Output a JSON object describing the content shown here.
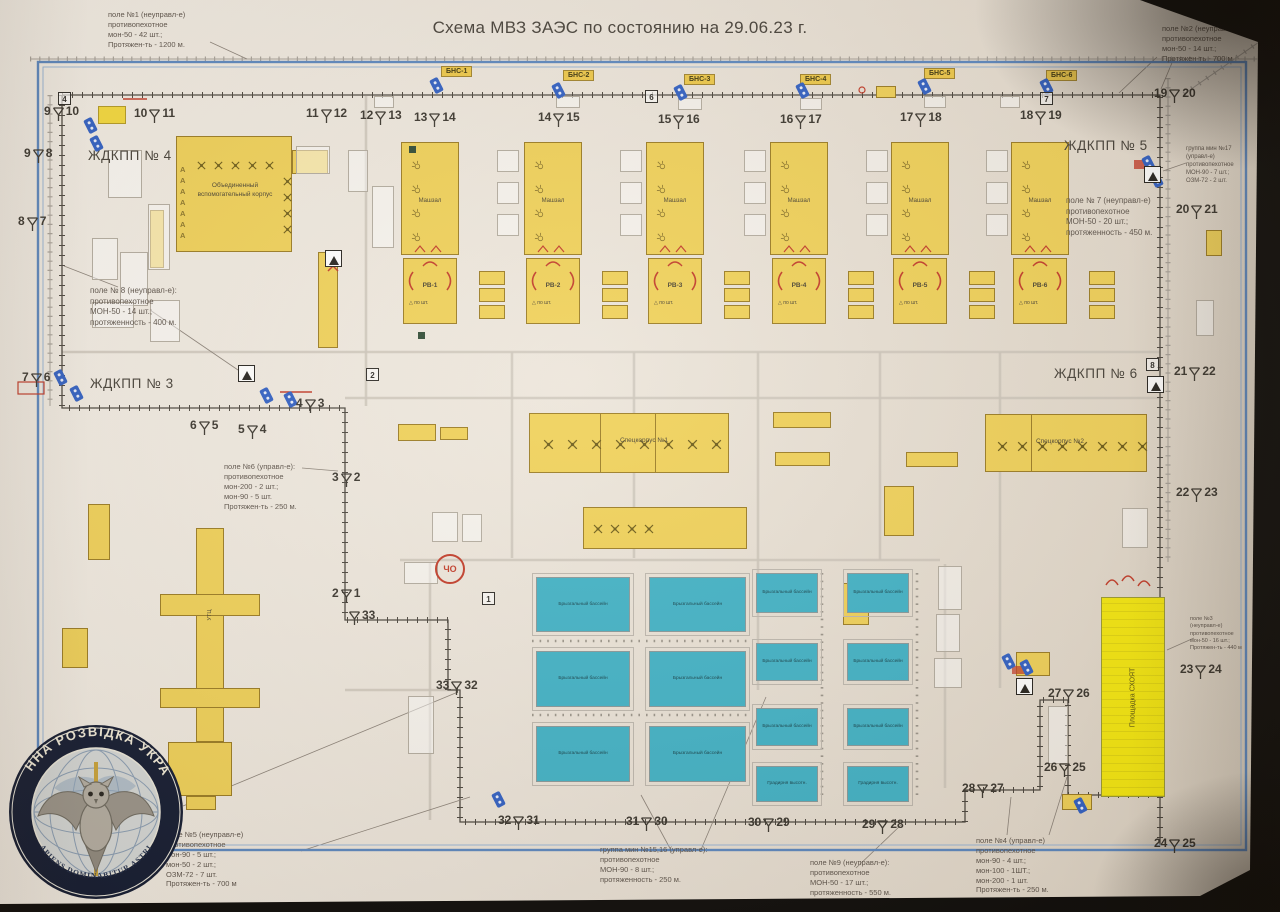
{
  "title": "Схема МВЗ ЗАЭС по состоянию на 29.06.23 г.",
  "colors": {
    "frame": "#5b87c0",
    "building": "#f0d158",
    "bright_building": "#f5e80e",
    "pool": "#3fb2c7",
    "camera": "#2f5fc4",
    "fence": "#4a453e",
    "red": "#c23a28"
  },
  "annotations": [
    {
      "x": 108,
      "y": 10,
      "fs": 7.5,
      "lines": [
        "поле №1 (неуправл-е)",
        "противопехотное",
        "мон-50 - 42 шт.;",
        "Протяжен-ть - 1200 м."
      ]
    },
    {
      "x": 1162,
      "y": 24,
      "fs": 7.5,
      "lines": [
        "поле №2 (неуправл-е)",
        "противопехотное",
        "мон-50 - 14 шт.;",
        "Протяжен-ть - 700 м"
      ]
    },
    {
      "x": 1186,
      "y": 146,
      "fs": 6,
      "lines": [
        "группа мин №17",
        "(управл-е)",
        "противопехотное",
        "МОН-90 - 7 шт.;",
        "ОЗМ-72 - 2 шт."
      ]
    },
    {
      "x": 1066,
      "y": 196,
      "fs": 8,
      "lines": [
        "поле № 7 (неуправл-е)",
        "противопехотное",
        "МОН-50 - 20 шт.;",
        "протяженность - 450 м."
      ]
    },
    {
      "x": 90,
      "y": 286,
      "fs": 8,
      "lines": [
        "поле № 8 (неуправл-е):",
        "противопехотное",
        "МОН-50 - 14 шт.;",
        "протяженность - 400 м."
      ]
    },
    {
      "x": 224,
      "y": 462,
      "fs": 7.5,
      "lines": [
        "поле №6 (управл-е):",
        "противопехотное",
        "мон-200 - 2 шт.;",
        "мон-90 - 5 шт.",
        "Протяжен-ть - 250 м."
      ]
    },
    {
      "x": 1190,
      "y": 616,
      "fs": 5.5,
      "lines": [
        "поле №3",
        "(неуправл-е)",
        "противопехотное",
        "мон-50 - 16 шт.;",
        "Протяжен-ть - 440 м"
      ]
    },
    {
      "x": 166,
      "y": 830,
      "fs": 7.5,
      "lines": [
        "поле №5 (неуправл-е)",
        "противопехотное",
        "мон-90 - 5 шт.;",
        "мон-50 - 2 шт.;",
        "ОЗМ-72 - 7 шт.",
        "Протяжен-ть - 700 м"
      ]
    },
    {
      "x": 600,
      "y": 845,
      "fs": 7.5,
      "lines": [
        "группа мин №15,16 (управл-е):",
        "противопехотное",
        "МОН-90 - 8 шт.;",
        "протяженность - 250 м."
      ]
    },
    {
      "x": 810,
      "y": 858,
      "fs": 7.5,
      "lines": [
        "поле №9 (неуправл-е):",
        "противопехотное",
        "МОН-50 - 17 шт.;",
        "протяженность - 550 м."
      ]
    },
    {
      "x": 976,
      "y": 836,
      "fs": 7.5,
      "lines": [
        "поле №4 (управл-е)",
        "противопехотное",
        "мон-90 - 4 шт.;",
        "мон-100 - 1ШТ.;",
        "мон-200 - 1 шт.",
        "Протяжен-ть - 250 м."
      ]
    }
  ],
  "checkpoints": [
    {
      "label": "ЖДКПП № 4",
      "x": 88,
      "y": 148
    },
    {
      "label": "ЖДКПП № 5",
      "x": 1064,
      "y": 138
    },
    {
      "label": "ЖДКПП № 3",
      "x": 90,
      "y": 376
    },
    {
      "label": "ЖДКПП № 6",
      "x": 1054,
      "y": 366
    }
  ],
  "bns": [
    {
      "label": "БНС-1",
      "x": 441,
      "y": 66
    },
    {
      "label": "БНС-2",
      "x": 563,
      "y": 70
    },
    {
      "label": "БНС-3",
      "x": 684,
      "y": 74
    },
    {
      "label": "БНС-4",
      "x": 800,
      "y": 74
    },
    {
      "label": "БНС-5",
      "x": 924,
      "y": 68
    },
    {
      "label": "БНС-6",
      "x": 1046,
      "y": 70
    }
  ],
  "markers": [
    {
      "a": "9",
      "b": "10",
      "x": 44,
      "y": 104
    },
    {
      "a": "10",
      "b": "11",
      "x": 134,
      "y": 106
    },
    {
      "a": "11",
      "b": "12",
      "x": 306,
      "y": 106
    },
    {
      "a": "12",
      "b": "13",
      "x": 360,
      "y": 108
    },
    {
      "a": "13",
      "b": "14",
      "x": 414,
      "y": 110
    },
    {
      "a": "14",
      "b": "15",
      "x": 538,
      "y": 110
    },
    {
      "a": "15",
      "b": "16",
      "x": 658,
      "y": 112
    },
    {
      "a": "16",
      "b": "17",
      "x": 780,
      "y": 112
    },
    {
      "a": "17",
      "b": "18",
      "x": 900,
      "y": 110
    },
    {
      "a": "18",
      "b": "19",
      "x": 1020,
      "y": 108
    },
    {
      "a": "19",
      "b": "20",
      "x": 1154,
      "y": 86
    },
    {
      "a": "9",
      "b": "8",
      "x": 24,
      "y": 146
    },
    {
      "a": "8",
      "b": "7",
      "x": 18,
      "y": 214
    },
    {
      "a": "7",
      "b": "6",
      "x": 22,
      "y": 370
    },
    {
      "a": "6",
      "b": "5",
      "x": 190,
      "y": 418
    },
    {
      "a": "5",
      "b": "4",
      "x": 238,
      "y": 422
    },
    {
      "a": "4",
      "b": "3",
      "x": 296,
      "y": 396
    },
    {
      "a": "3",
      "b": "2",
      "x": 332,
      "y": 470
    },
    {
      "a": "2",
      "b": "1",
      "x": 332,
      "y": 586
    },
    {
      "a": "",
      "b": "33",
      "x": 348,
      "y": 608
    },
    {
      "a": "33",
      "b": "32",
      "x": 436,
      "y": 678
    },
    {
      "a": "32",
      "b": "31",
      "x": 498,
      "y": 813
    },
    {
      "a": "31",
      "b": "30",
      "x": 626,
      "y": 814
    },
    {
      "a": "30",
      "b": "29",
      "x": 748,
      "y": 815
    },
    {
      "a": "29",
      "b": "28",
      "x": 862,
      "y": 817
    },
    {
      "a": "28",
      "b": "27",
      "x": 962,
      "y": 781
    },
    {
      "a": "27",
      "b": "26",
      "x": 1048,
      "y": 686
    },
    {
      "a": "26",
      "b": "25",
      "x": 1044,
      "y": 760
    },
    {
      "a": "24",
      "b": "25",
      "x": 1154,
      "y": 836
    },
    {
      "a": "20",
      "b": "21",
      "x": 1176,
      "y": 202
    },
    {
      "a": "21",
      "b": "22",
      "x": 1174,
      "y": 364
    },
    {
      "a": "22",
      "b": "23",
      "x": 1176,
      "y": 485
    },
    {
      "a": "23",
      "b": "24",
      "x": 1180,
      "y": 662
    }
  ],
  "boxed_numbers": [
    {
      "n": "4",
      "x": 58,
      "y": 92
    },
    {
      "n": "6",
      "x": 645,
      "y": 90
    },
    {
      "n": "7",
      "x": 1040,
      "y": 92
    },
    {
      "n": "2",
      "x": 366,
      "y": 368
    },
    {
      "n": "1",
      "x": 482,
      "y": 592
    },
    {
      "n": "8",
      "x": 1146,
      "y": 358
    }
  ],
  "buildings": {
    "ovk": {
      "label": "Объединенный вспомогательный корпус",
      "a_column": "ААААААА",
      "x": 176,
      "y": 136,
      "w": 116,
      "h": 116,
      "wing": [
        292,
        150,
        36,
        24
      ]
    },
    "mashzal": {
      "label": "Машзал",
      "xs": [
        401,
        524,
        646,
        770,
        891,
        1011
      ],
      "y": 142,
      "w": 58,
      "h": 113
    },
    "reactors": {
      "labels": [
        "РВ-1",
        "РВ-2",
        "РВ-3",
        "РВ-4",
        "РВ-5",
        "РВ-6"
      ],
      "tri_icon": "△",
      "sub": "по шт.",
      "y": 258,
      "w": 54,
      "h": 66
    },
    "rdes_stacks": {
      "xs": [
        479,
        602,
        724,
        848,
        969,
        1089
      ],
      "y": 271,
      "box_w": 26,
      "box_h": 14,
      "count": 3
    },
    "spec1": {
      "label": "Спецкорпус №1",
      "x": 529,
      "y": 413,
      "w": 200,
      "h": 60
    },
    "spec2": {
      "label": "Спецкорпус №2",
      "x": 985,
      "y": 414,
      "w": 162,
      "h": 58
    },
    "lower": {
      "x": 583,
      "y": 507,
      "w": 164,
      "h": 42
    },
    "schoyat": {
      "label": "Площадка СХОЯТ",
      "x": 1101,
      "y": 597,
      "w": 64,
      "h": 200
    },
    "cho": {
      "label": "ЧО",
      "x": 435,
      "y": 554
    },
    "utc": {
      "label": "УТЦ",
      "rects": [
        [
          196,
          528,
          28,
          214
        ],
        [
          160,
          594,
          100,
          22
        ],
        [
          160,
          688,
          100,
          20
        ],
        [
          168,
          742,
          64,
          54
        ],
        [
          186,
          796,
          30,
          14
        ]
      ]
    },
    "ramp": [
      318,
      252,
      20,
      96
    ],
    "misc_yellow": [
      [
        398,
        424,
        38,
        17
      ],
      [
        440,
        427,
        28,
        13
      ],
      [
        773,
        412,
        58,
        16
      ],
      [
        775,
        452,
        55,
        14
      ],
      [
        906,
        452,
        52,
        15
      ],
      [
        884,
        486,
        30,
        50
      ],
      [
        843,
        583,
        26,
        42
      ],
      [
        1016,
        652,
        34,
        24
      ],
      [
        88,
        504,
        22,
        56
      ],
      [
        62,
        628,
        26,
        40
      ],
      [
        1206,
        230,
        16,
        26
      ],
      [
        1062,
        794,
        30,
        16
      ],
      [
        150,
        210,
        14,
        58
      ],
      [
        876,
        86,
        20,
        12
      ]
    ],
    "misc_white": [
      [
        108,
        150,
        34,
        48
      ],
      [
        148,
        204,
        22,
        66
      ],
      [
        92,
        238,
        26,
        42
      ],
      [
        120,
        252,
        28,
        54
      ],
      [
        92,
        302,
        42,
        26
      ],
      [
        150,
        300,
        30,
        42
      ],
      [
        296,
        146,
        34,
        28
      ],
      [
        348,
        150,
        20,
        42
      ],
      [
        372,
        186,
        22,
        62
      ],
      [
        497,
        150,
        22,
        22
      ],
      [
        497,
        182,
        22,
        22
      ],
      [
        497,
        214,
        22,
        22
      ],
      [
        620,
        150,
        22,
        22
      ],
      [
        620,
        182,
        22,
        22
      ],
      [
        620,
        214,
        22,
        22
      ],
      [
        744,
        150,
        22,
        22
      ],
      [
        744,
        182,
        22,
        22
      ],
      [
        744,
        214,
        22,
        22
      ],
      [
        866,
        150,
        22,
        22
      ],
      [
        866,
        182,
        22,
        22
      ],
      [
        866,
        214,
        22,
        22
      ],
      [
        986,
        150,
        22,
        22
      ],
      [
        986,
        182,
        22,
        22
      ],
      [
        986,
        214,
        22,
        22
      ],
      [
        374,
        96,
        20,
        12
      ],
      [
        556,
        96,
        24,
        12
      ],
      [
        678,
        98,
        24,
        12
      ],
      [
        800,
        98,
        22,
        12
      ],
      [
        924,
        96,
        22,
        12
      ],
      [
        1000,
        96,
        20,
        12
      ],
      [
        432,
        512,
        26,
        30
      ],
      [
        462,
        514,
        20,
        28
      ],
      [
        404,
        562,
        34,
        22
      ],
      [
        938,
        566,
        24,
        44
      ],
      [
        936,
        614,
        24,
        38
      ],
      [
        934,
        658,
        28,
        30
      ],
      [
        1122,
        508,
        26,
        40
      ],
      [
        1196,
        300,
        18,
        36
      ],
      [
        1048,
        706,
        20,
        58
      ],
      [
        408,
        696,
        26,
        58
      ]
    ]
  },
  "pools": {
    "label": "Брызгальный бассейн",
    "label2": "Градирня высотн.",
    "large": [
      [
        536,
        577,
        94,
        55
      ],
      [
        649,
        577,
        97,
        55
      ],
      [
        536,
        651,
        94,
        56
      ],
      [
        649,
        651,
        97,
        56
      ],
      [
        536,
        726,
        94,
        56
      ],
      [
        649,
        726,
        97,
        56
      ]
    ],
    "small": [
      [
        756,
        573,
        62,
        40
      ],
      [
        847,
        573,
        62,
        40
      ],
      [
        756,
        643,
        62,
        38
      ],
      [
        847,
        643,
        62,
        38
      ],
      [
        756,
        708,
        62,
        38
      ],
      [
        847,
        708,
        62,
        38
      ]
    ],
    "towers": [
      [
        756,
        766,
        62,
        36
      ],
      [
        847,
        766,
        62,
        36
      ]
    ]
  },
  "legend_square": [
    98,
    106,
    26,
    16
  ],
  "cameras": [
    [
      432,
      78
    ],
    [
      554,
      83
    ],
    [
      676,
      85
    ],
    [
      798,
      83
    ],
    [
      920,
      79
    ],
    [
      1042,
      79
    ],
    [
      86,
      118
    ],
    [
      92,
      136
    ],
    [
      1144,
      156
    ],
    [
      1152,
      172
    ],
    [
      56,
      370
    ],
    [
      72,
      386
    ],
    [
      262,
      388
    ],
    [
      286,
      392
    ],
    [
      1004,
      654
    ],
    [
      1022,
      660
    ],
    [
      494,
      792
    ],
    [
      1076,
      798
    ]
  ],
  "triangle_signs": [
    [
      238,
      365
    ],
    [
      1144,
      166
    ],
    [
      1147,
      376
    ],
    [
      325,
      250
    ],
    [
      1016,
      678
    ]
  ],
  "dark_squares": [
    [
      409,
      146
    ],
    [
      418,
      332
    ]
  ],
  "paths": {
    "fence": [
      "M62 95 H1160 V845",
      "M62 95 V408 H345 V620 H448 V690 H460 V822 H965 V790 H1040 V700 H1068 V795 H1160"
    ],
    "rails": [
      "M30 59 H1270",
      "M1168 78 V562",
      "M1184 94 L1262 40",
      "M50 95 V406"
    ],
    "roads": [
      "M62 352 H1160",
      "M345 398 H1160",
      "M366 96 V406",
      "M400 560 H940",
      "M430 562 V820",
      "M945 564 V788",
      "M512 352 V558",
      "M634 352 V558",
      "M758 352 V690",
      "M880 352 V560",
      "M1000 352 V688",
      "M345 690 H458"
    ],
    "dotted": [
      "M532 641 H750",
      "M532 715 H750",
      "M822 573 V800",
      "M917 573 V800"
    ],
    "leaders": [
      [
        210,
        42,
        247,
        59
      ],
      [
        1157,
        57,
        1119,
        93
      ],
      [
        1174,
        58,
        1161,
        89
      ],
      [
        118,
        287,
        64,
        266
      ],
      [
        150,
        310,
        238,
        370
      ],
      [
        302,
        468,
        338,
        471
      ],
      [
        1186,
        163,
        1163,
        171
      ],
      [
        1194,
        638,
        1167,
        650
      ],
      [
        183,
        806,
        458,
        692
      ],
      [
        301,
        851,
        470,
        797
      ],
      [
        672,
        852,
        641,
        795
      ],
      [
        700,
        852,
        766,
        697
      ],
      [
        856,
        868,
        901,
        825
      ],
      [
        1007,
        835,
        1011,
        797
      ],
      [
        1049,
        835,
        1067,
        777
      ]
    ]
  },
  "logo": {
    "ring_top": "ВОЄННА  РОЗВІДКА  УКРАЇНИ",
    "motto": "SAPIENS DOMINABITUR ASTRIS"
  }
}
